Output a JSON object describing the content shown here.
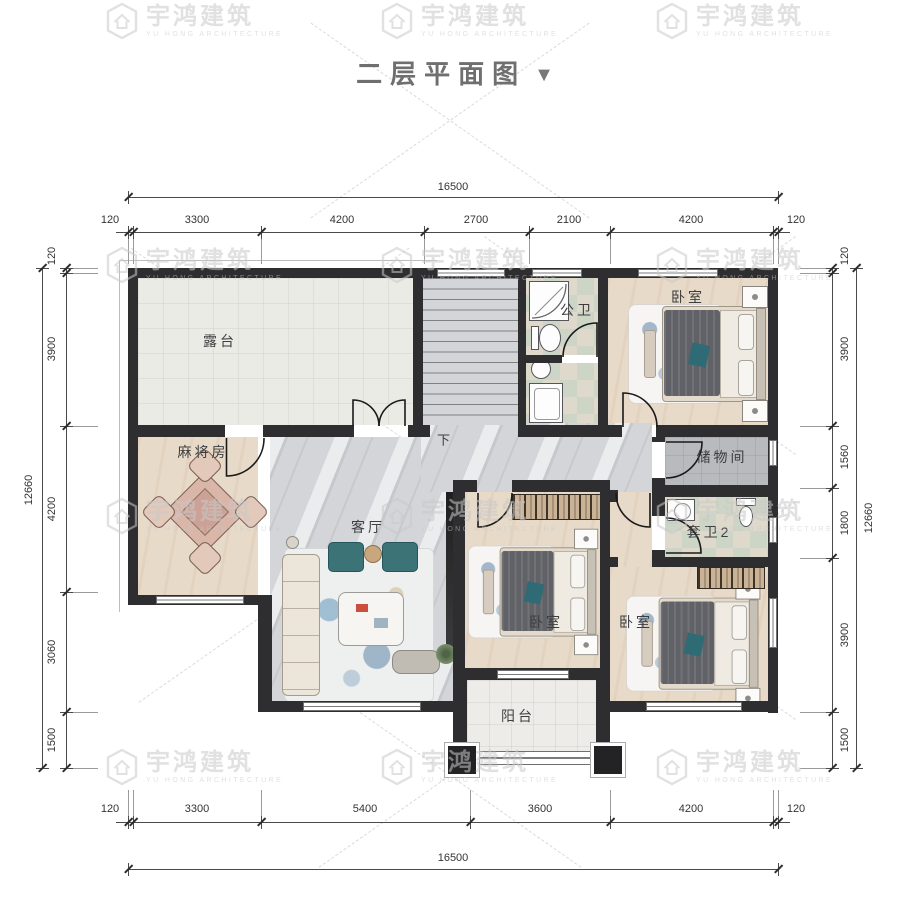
{
  "title": {
    "text": "二层平面图",
    "arrow": "▼"
  },
  "watermark": {
    "brand": "宇鸿建筑",
    "brand_en": "YU HONG ARCHITECTURE"
  },
  "rooms": {
    "terrace": "露台",
    "mahjong": "麻将房",
    "living": "客厅",
    "public_bath": "公卫",
    "bedroom_top": "卧室",
    "storage": "储物间",
    "ensuite": "套卫2",
    "bedroom_mid": "卧室",
    "bedroom_right": "卧室",
    "balcony": "阳台",
    "stair_down": "下"
  },
  "dimensions": {
    "top": {
      "total": "16500",
      "segments": [
        "120",
        "3300",
        "4200",
        "2700",
        "2100",
        "4200",
        "120"
      ]
    },
    "bottom": {
      "total": "16500",
      "segments": [
        "120",
        "3300",
        "5400",
        "3600",
        "4200",
        "120"
      ]
    },
    "left": {
      "total": "12660",
      "segments": [
        "120",
        "3900",
        "4200",
        "3060",
        "1500"
      ]
    },
    "right": {
      "total": "12660",
      "segments": [
        "120",
        "3900",
        "1560",
        "1800",
        "3900",
        "1500"
      ]
    }
  },
  "colors": {
    "wall": "#2e2e30",
    "wood": "#e8dac8",
    "marble": "#d3d5d8",
    "terrace": "#e9ebe4",
    "bath_tile": "#cdd5c6",
    "storage_tile": "#b9babd",
    "balcony": "#edece8",
    "accent_teal": "#2f6b74",
    "dim_text": "#333333"
  }
}
